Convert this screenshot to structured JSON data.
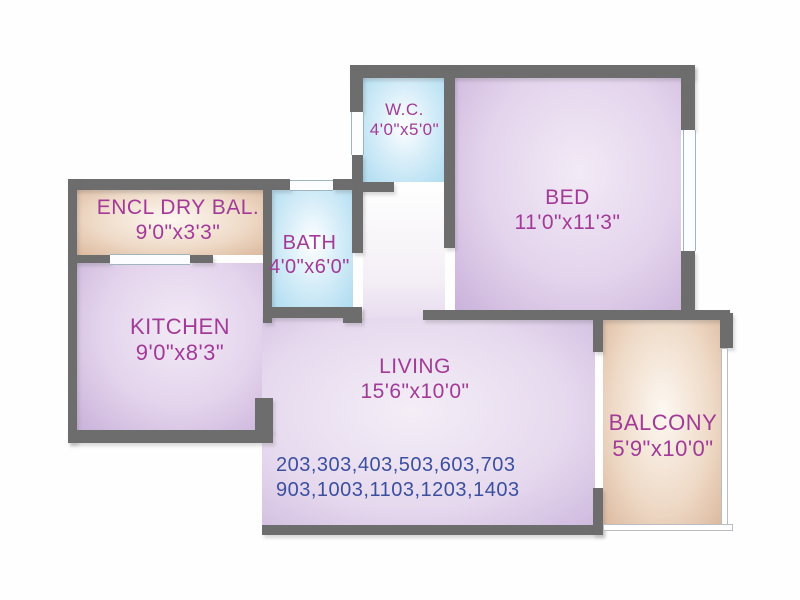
{
  "plan": {
    "type": "apartment-floor-plan",
    "colors": {
      "wall": "#6d6d6d",
      "room_label_text": "#a23b97",
      "unit_numbers_text": "#3c4f9f",
      "wet_room_fill": "#aedcf0",
      "lavender_room_fill": "#d7c3e4",
      "balcony_fill": "#dcb99e",
      "background": "#fefefe"
    },
    "rooms": {
      "wc": {
        "name": "W.C.",
        "size": "4'0\"x5'0\""
      },
      "bed": {
        "name": "BED",
        "size": "11'0\"x11'3\""
      },
      "drybal": {
        "name": "ENCL DRY BAL.",
        "size": "9'0\"x3'3\""
      },
      "bath": {
        "name": "BATH",
        "size": "4'0\"x6'0\""
      },
      "kitchen": {
        "name": "KITCHEN",
        "size": "9'0\"x8'3\""
      },
      "living": {
        "name": "LIVING",
        "size": "15'6\"x10'0\""
      },
      "balcony": {
        "name": "BALCONY",
        "size": "5'9\"x10'0\""
      }
    },
    "unit_numbers": {
      "line1": "203,303,403,503,603,703",
      "line2": "903,1003,1103,1203,1403"
    }
  }
}
